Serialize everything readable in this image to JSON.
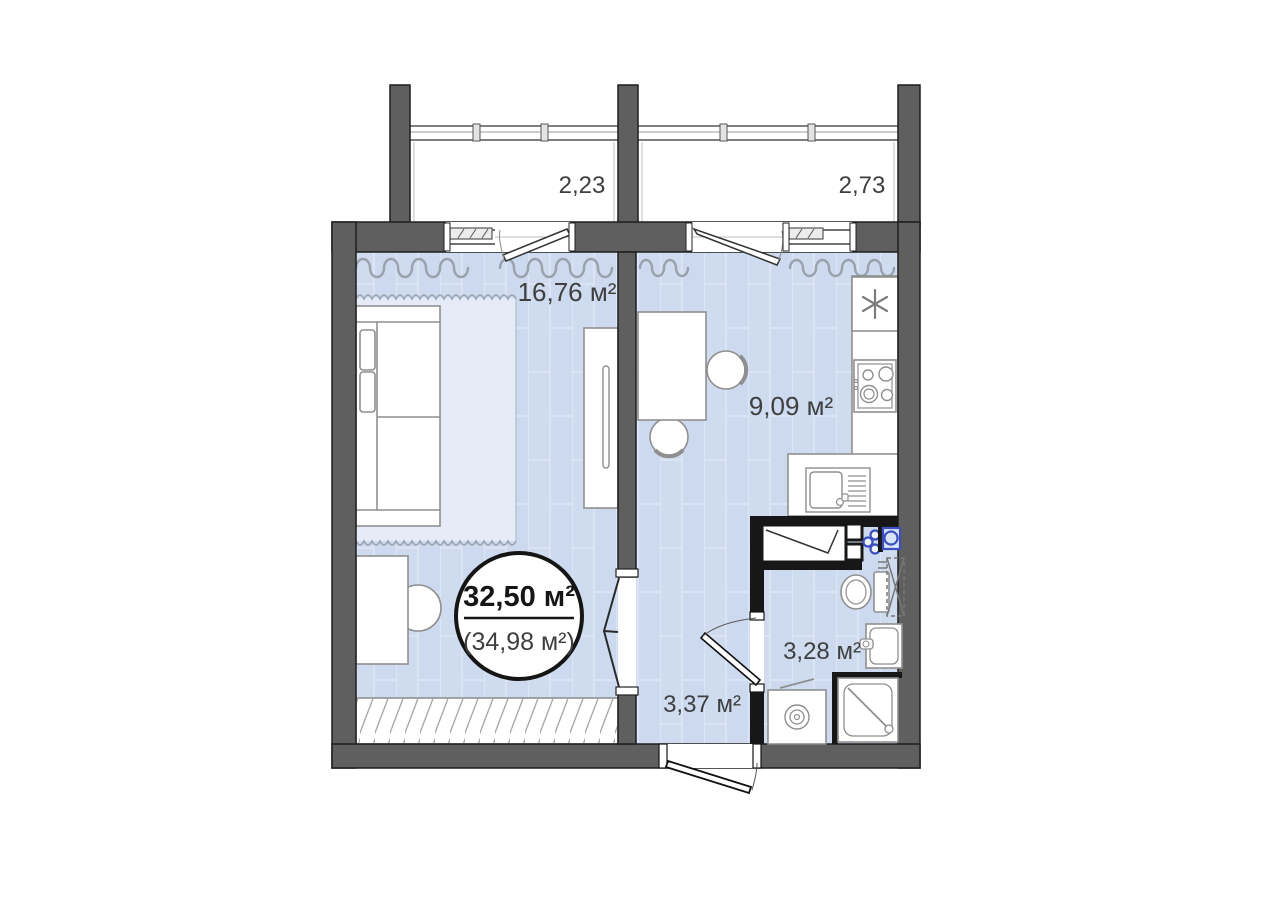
{
  "page": {
    "type": "apartment-floor-plan"
  },
  "rooms": {
    "living": {
      "label": "16,76 м²"
    },
    "kitchen": {
      "label": "9,09 м²"
    },
    "bathroom": {
      "label": "3,28 м²"
    },
    "hallway": {
      "label": "3,37 м²"
    },
    "balcony_left": {
      "label": "2,23"
    },
    "balcony_right": {
      "label": "2,73"
    }
  },
  "badge": {
    "total": "32,50 м²",
    "with_balconies": "(34,98 м²)"
  },
  "colors": {
    "wall_gray": "#5f5f5f",
    "wall_outline": "#1f1f1f",
    "wet_zone_wall": "#171717",
    "floor_blue": "#cfdcf0",
    "floor_line": "#e2eaf8",
    "rug": "#e6ecf7",
    "furniture_stroke": "#8f8f8f",
    "curtain_gray": "#98a1ac",
    "label_text": "#3f3f3f",
    "plumbing_blue": "#3b4fc0"
  },
  "icons": {
    "fridge": "fridge-asterisk-icon",
    "stove": "stove-four-burners-icon",
    "kitchen_sink": "sink-with-drainer-icon",
    "toilet": "toilet-icon",
    "towel_rail": "heated-towel-rail-icon",
    "washbasin": "washbasin-icon",
    "shower": "shower-tray-icon",
    "washer": "washing-machine-icon",
    "fan": "ventilation-fan-icon",
    "valves": "water-valves-icon",
    "doorway": "open-doorway-arrow-icon"
  }
}
